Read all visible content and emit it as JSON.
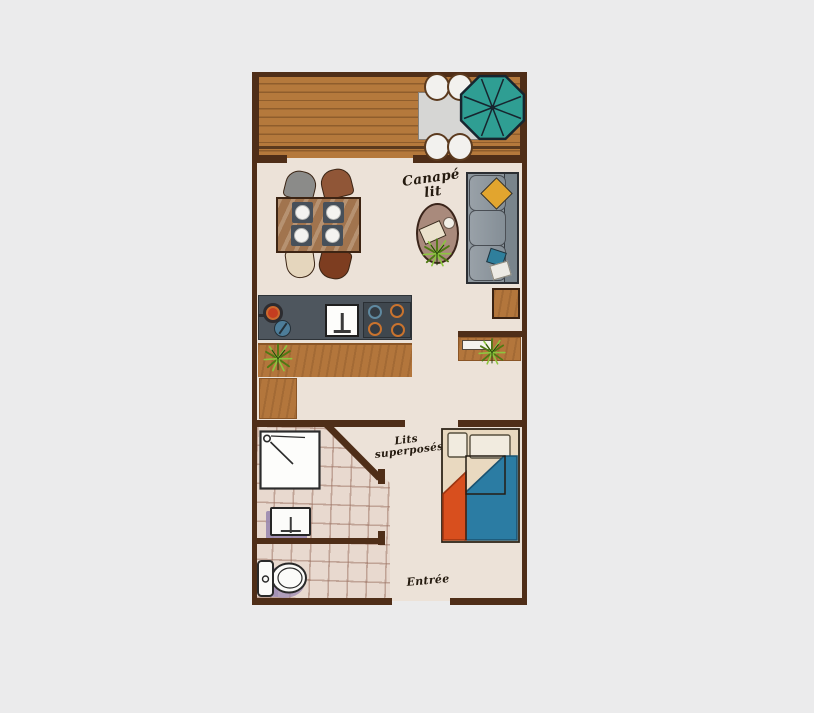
{
  "canvas": {
    "width": 814,
    "height": 713,
    "background": "#ebebec"
  },
  "floor_plan": {
    "labels": {
      "sofa_bed": {
        "line1": "Canapé",
        "line2": "lit"
      },
      "bunk_beds": {
        "line1": "Lits",
        "line2": "superposés"
      },
      "entrance": {
        "text": "Entrée"
      }
    },
    "icons": [
      "parasol-icon",
      "plant-icon",
      "shower-icon",
      "washbasin-icon",
      "toilet-icon",
      "kitchen-sink-icon",
      "stove-icon",
      "pot-icon",
      "frying-pan-icon"
    ],
    "palette": {
      "background": "#ebebec",
      "wall": "#4f2e18",
      "interior_floor": "#ece2d8",
      "deck_wood": "#b5793c",
      "deck_plank_line": "#8f5d2c",
      "counter_wood": "#b3763c",
      "kitchen_worktop": "#4e565e",
      "parasol_teal": "#2f9e93",
      "sofa_gray": "#8d969d",
      "rug_mauve": "#a98a7c",
      "pillow_yellow": "#e2a52e",
      "pillow_teal": "#2f7f9c",
      "blanket_orange": "#d84f1e",
      "blanket_blue": "#2b7ca3",
      "bathroom_tile": "#e8d9cf",
      "fixture_shadow_purple": "#a18fb4",
      "plant_green": "#7ab52a"
    }
  }
}
